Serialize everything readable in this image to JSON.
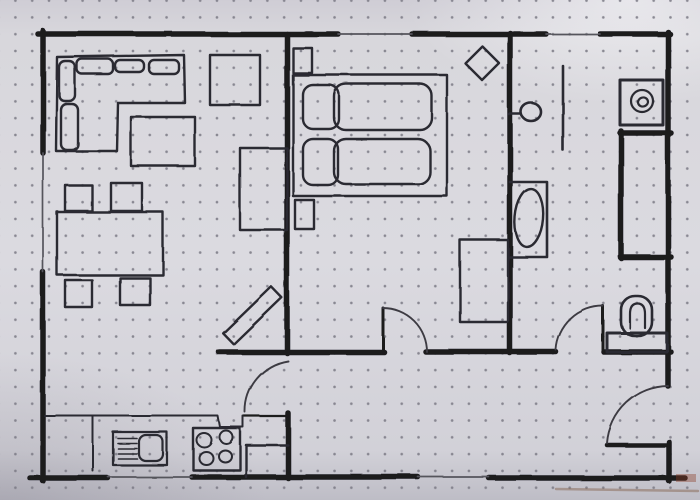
{
  "meta": {
    "description": "hand-drawn apartment floor plan sketched in black marker on dot-grid paper",
    "visible_text": "none"
  },
  "style": {
    "paper_color": "#d8d7dc",
    "dot_color": "#7a7984",
    "wall_ink": "#1b1a1f",
    "furniture_ink": "#2a2930",
    "thin_ink": "#3c3b43",
    "window_ink": "#55545c",
    "wall_stroke": 5.5,
    "furniture_stroke": 2.4,
    "arc_stroke": 1.9,
    "window_stroke": 1.7
  },
  "plan": {
    "walls": [
      {
        "name": "wall-top-living",
        "x1": 38,
        "y1": 34,
        "x2": 338,
        "y2": 34
      },
      {
        "name": "wall-top-bedroom-right",
        "x1": 412,
        "y1": 34,
        "x2": 546,
        "y2": 34
      },
      {
        "name": "wall-top-bathroom",
        "x1": 600,
        "y1": 34,
        "x2": 670,
        "y2": 34
      },
      {
        "name": "wall-left-upper",
        "x1": 43,
        "y1": 31,
        "x2": 43,
        "y2": 153
      },
      {
        "name": "wall-left-lower",
        "x1": 43,
        "y1": 272,
        "x2": 43,
        "y2": 481
      },
      {
        "name": "wall-bottom-left",
        "x1": 30,
        "y1": 478,
        "x2": 108,
        "y2": 478
      },
      {
        "name": "wall-bottom-middle",
        "x1": 192,
        "y1": 477,
        "x2": 418,
        "y2": 477
      },
      {
        "name": "wall-bottom-right",
        "x1": 489,
        "y1": 478,
        "x2": 685,
        "y2": 478
      },
      {
        "name": "wall-right-upper",
        "x1": 668,
        "y1": 32,
        "x2": 668,
        "y2": 386
      },
      {
        "name": "wall-right-lower",
        "x1": 669,
        "y1": 442,
        "x2": 669,
        "y2": 481
      },
      {
        "name": "wall-living-bedroom",
        "x1": 287,
        "y1": 34,
        "x2": 287,
        "y2": 353
      },
      {
        "name": "wall-hall-top-left",
        "x1": 219,
        "y1": 352,
        "x2": 384,
        "y2": 352
      },
      {
        "name": "wall-hall-top-middle",
        "x1": 426,
        "y1": 352,
        "x2": 556,
        "y2": 352
      },
      {
        "name": "wall-wc-bottom",
        "x1": 604,
        "y1": 352,
        "x2": 671,
        "y2": 352
      },
      {
        "name": "wall-bedroom-bathroom",
        "x1": 510,
        "y1": 33,
        "x2": 510,
        "y2": 353
      },
      {
        "name": "wall-kitchen-door-jamb",
        "x1": 288,
        "y1": 413,
        "x2": 288,
        "y2": 478
      },
      {
        "name": "wall-closet-top",
        "x1": 620,
        "y1": 133,
        "x2": 671,
        "y2": 133
      },
      {
        "name": "wall-closet-left",
        "x1": 621,
        "y1": 131,
        "x2": 621,
        "y2": 258
      },
      {
        "name": "wall-closet-bottom",
        "x1": 620,
        "y1": 257,
        "x2": 671,
        "y2": 257
      }
    ],
    "windows": [
      {
        "name": "window-top-bedroom",
        "x1": 338,
        "y1": 34,
        "x2": 412,
        "y2": 34
      },
      {
        "name": "window-top-bathroom",
        "x1": 546,
        "y1": 34,
        "x2": 600,
        "y2": 34
      },
      {
        "name": "window-left-living",
        "x1": 43,
        "y1": 153,
        "x2": 43,
        "y2": 272
      },
      {
        "name": "window-bottom-kitchen",
        "x1": 108,
        "y1": 477,
        "x2": 192,
        "y2": 477
      },
      {
        "name": "window-bottom-hall",
        "x1": 418,
        "y1": 477,
        "x2": 489,
        "y2": 477
      }
    ],
    "doors": [
      {
        "name": "door-bedroom",
        "leaf": [
          383,
          352,
          383,
          308
        ],
        "leaf_w": 3,
        "arc": "M383,308 A44,44 0 0 1 427,352"
      },
      {
        "name": "door-kitchen",
        "leaf": [
          288,
          416,
          244,
          416
        ],
        "leaf_w": 2.2,
        "arc": "M288,361 A51,51 0 0 0 245,412"
      },
      {
        "name": "door-bathroom",
        "leaf": [
          603,
          352,
          603,
          306
        ],
        "leaf_w": 3,
        "arc": "M603,306 A47,47 0 0 0 556,350"
      },
      {
        "name": "door-entrance",
        "leaf": [
          607,
          445,
          669,
          445
        ],
        "leaf_w": 4.5,
        "arc": "M607,443 A62,62 0 0 1 668,386"
      }
    ],
    "furniture": [
      {
        "name": "corner-sofa-outline",
        "room": "living-room",
        "shape": "polygon",
        "points": "57,57 184,55 185,103 118,103 117,151 56,151"
      },
      {
        "name": "sofa-cushion",
        "room": "living-room",
        "shape": "rect",
        "x": 77,
        "y": 59,
        "w": 36,
        "h": 15,
        "rx": 5
      },
      {
        "name": "sofa-cushion",
        "room": "living-room",
        "shape": "rect",
        "x": 115,
        "y": 60,
        "w": 29,
        "h": 12,
        "rx": 5
      },
      {
        "name": "sofa-cushion",
        "room": "living-room",
        "shape": "rect",
        "x": 149,
        "y": 60,
        "w": 30,
        "h": 14,
        "rx": 5
      },
      {
        "name": "sofa-cushion",
        "room": "living-room",
        "shape": "rect",
        "x": 59,
        "y": 61,
        "w": 16,
        "h": 40,
        "rx": 6
      },
      {
        "name": "sofa-cushion",
        "room": "living-room",
        "shape": "rect",
        "x": 61,
        "y": 104,
        "w": 17,
        "h": 46,
        "rx": 6
      },
      {
        "name": "side-table",
        "room": "living-room",
        "shape": "rect",
        "x": 210,
        "y": 55,
        "w": 50,
        "h": 50
      },
      {
        "name": "coffee-table",
        "room": "living-room",
        "shape": "rect",
        "x": 131,
        "y": 117,
        "w": 64,
        "h": 49
      },
      {
        "name": "desk",
        "room": "living-room",
        "shape": "rect",
        "x": 240,
        "y": 148,
        "w": 47,
        "h": 82
      },
      {
        "name": "dining-table",
        "room": "living-room",
        "shape": "rect",
        "x": 57,
        "y": 212,
        "w": 106,
        "h": 63
      },
      {
        "name": "dining-chair",
        "room": "living-room",
        "shape": "rect",
        "x": 65,
        "y": 185,
        "w": 27,
        "h": 26
      },
      {
        "name": "dining-chair",
        "room": "living-room",
        "shape": "rect",
        "x": 111,
        "y": 183,
        "w": 31,
        "h": 28
      },
      {
        "name": "dining-chair",
        "room": "living-room",
        "shape": "rect",
        "x": 65,
        "y": 280,
        "w": 27,
        "h": 27
      },
      {
        "name": "dining-chair",
        "room": "living-room",
        "shape": "rect",
        "x": 120,
        "y": 278,
        "w": 30,
        "h": 27
      },
      {
        "name": "sideboard-diagonal",
        "room": "living-room",
        "shape": "rect",
        "x": 219,
        "y": 308,
        "w": 67,
        "h": 15,
        "rot": -44
      },
      {
        "name": "nightstand",
        "room": "bedroom",
        "shape": "rect",
        "x": 293,
        "y": 48,
        "w": 19,
        "h": 25
      },
      {
        "name": "nightstand",
        "room": "bedroom",
        "shape": "rect",
        "x": 295,
        "y": 200,
        "w": 19,
        "h": 29
      },
      {
        "name": "double-bed-frame",
        "room": "bedroom",
        "shape": "rect",
        "x": 293,
        "y": 75,
        "w": 154,
        "h": 121
      },
      {
        "name": "pillow",
        "room": "bedroom",
        "shape": "rect",
        "x": 303,
        "y": 85,
        "w": 36,
        "h": 44,
        "rx": 10
      },
      {
        "name": "pillow",
        "room": "bedroom",
        "shape": "rect",
        "x": 303,
        "y": 139,
        "w": 35,
        "h": 46,
        "rx": 10
      },
      {
        "name": "duvet",
        "room": "bedroom",
        "shape": "rect",
        "x": 334,
        "y": 84,
        "w": 98,
        "h": 46,
        "rx": 12
      },
      {
        "name": "duvet",
        "room": "bedroom",
        "shape": "rect",
        "x": 334,
        "y": 139,
        "w": 96,
        "h": 45,
        "rx": 12
      },
      {
        "name": "plant-diamond",
        "room": "bedroom",
        "shape": "polygon",
        "points": "482,46 499,63 482,80 465,63"
      },
      {
        "name": "wardrobe",
        "room": "bedroom",
        "shape": "rect",
        "x": 460,
        "y": 240,
        "w": 48,
        "h": 82
      },
      {
        "name": "wall-hook-stem",
        "room": "bathroom",
        "shape": "line",
        "x1": 509,
        "y1": 114,
        "x2": 521,
        "y2": 114,
        "sw": 2.6
      },
      {
        "name": "wall-hook-ring",
        "room": "bathroom",
        "shape": "ellipse",
        "cx": 531,
        "cy": 112,
        "rx": 10,
        "ry": 9,
        "sw": 2.6
      },
      {
        "name": "radiator-line",
        "room": "bathroom",
        "shape": "line",
        "x1": 563,
        "y1": 66,
        "x2": 563,
        "y2": 150,
        "sw": 2.6
      },
      {
        "name": "washing-machine",
        "room": "bathroom",
        "shape": "rect",
        "x": 620,
        "y": 80,
        "w": 43,
        "h": 45,
        "sw": 3
      },
      {
        "name": "washing-machine-drum",
        "room": "bathroom",
        "shape": "circle",
        "cx": 642,
        "cy": 101,
        "r": 11,
        "sw": 2.2
      },
      {
        "name": "washing-machine-door",
        "room": "bathroom",
        "shape": "ellipse",
        "cx": 643,
        "cy": 102,
        "rx": 5,
        "ry": 4.5,
        "rot": -15,
        "sw": 2.2
      },
      {
        "name": "washbasin-unit",
        "room": "bathroom",
        "shape": "path",
        "d": "M510,182 L547,182 L547,257 L510,257",
        "sw": 2.6
      },
      {
        "name": "washbasin-bowl",
        "room": "bathroom",
        "shape": "ellipse",
        "cx": 529,
        "cy": 218,
        "rx": 14,
        "ry": 29,
        "rot": 5,
        "sw": 2.4
      },
      {
        "name": "toilet-tank",
        "room": "wc",
        "shape": "rect",
        "x": 607,
        "y": 333,
        "w": 60,
        "h": 19,
        "sw": 3
      },
      {
        "name": "toilet-bowl",
        "room": "wc",
        "shape": "rect",
        "x": 621,
        "y": 296,
        "w": 31,
        "h": 40,
        "rx": 14,
        "sw": 2.6
      },
      {
        "name": "toilet-seat",
        "room": "wc",
        "shape": "path",
        "d": "M630,328 L630,314 Q630,303.5 637.5,303.5 Q645,303.5 645,314 L645,328",
        "sw": 2.2
      },
      {
        "name": "counter-edge",
        "room": "kitchen",
        "shape": "polyline",
        "points": "45,416 218,416 220,427 243,427 243,416",
        "sw": 2
      },
      {
        "name": "counter-divider",
        "room": "kitchen",
        "shape": "line",
        "x1": 93,
        "y1": 417,
        "x2": 93,
        "y2": 471,
        "sw": 2
      },
      {
        "name": "corner-cabinet",
        "room": "kitchen",
        "shape": "polyline",
        "points": "288,445 246,445 246,477",
        "sw": 2.4
      },
      {
        "name": "sink-unit",
        "room": "kitchen",
        "shape": "rect",
        "x": 113,
        "y": 432,
        "w": 54,
        "h": 33,
        "sw": 2.2
      },
      {
        "name": "sink-drainer-line",
        "room": "kitchen",
        "shape": "line",
        "x1": 118,
        "y1": 438.5,
        "x2": 137,
        "y2": 438.5,
        "sw": 1.6
      },
      {
        "name": "sink-drainer-line",
        "room": "kitchen",
        "shape": "line",
        "x1": 118,
        "y1": 443.5,
        "x2": 137,
        "y2": 443.5,
        "sw": 1.6
      },
      {
        "name": "sink-drainer-line",
        "room": "kitchen",
        "shape": "line",
        "x1": 118,
        "y1": 448.5,
        "x2": 137,
        "y2": 448.5,
        "sw": 1.6
      },
      {
        "name": "sink-drainer-line",
        "room": "kitchen",
        "shape": "line",
        "x1": 118,
        "y1": 453.5,
        "x2": 137,
        "y2": 453.5,
        "sw": 1.6
      },
      {
        "name": "sink-drainer-line",
        "room": "kitchen",
        "shape": "line",
        "x1": 118,
        "y1": 458.5,
        "x2": 137,
        "y2": 458.5,
        "sw": 1.6
      },
      {
        "name": "sink-basin",
        "room": "kitchen",
        "shape": "rect",
        "x": 139,
        "y": 435,
        "w": 24,
        "h": 26,
        "rx": 7,
        "sw": 2.2
      },
      {
        "name": "stove",
        "room": "kitchen",
        "shape": "rect",
        "x": 193,
        "y": 428,
        "w": 47,
        "h": 42,
        "sw": 2.4
      },
      {
        "name": "stove-burner",
        "room": "kitchen",
        "shape": "ellipse",
        "cx": 204,
        "cy": 440,
        "rx": 7.5,
        "ry": 7,
        "sw": 2
      },
      {
        "name": "stove-burner",
        "room": "kitchen",
        "shape": "ellipse",
        "cx": 226,
        "cy": 437,
        "rx": 6.5,
        "ry": 6.5,
        "sw": 2
      },
      {
        "name": "stove-burner",
        "room": "kitchen",
        "shape": "ellipse",
        "cx": 206,
        "cy": 458,
        "rx": 7,
        "ry": 6.5,
        "sw": 2
      },
      {
        "name": "stove-burner",
        "room": "kitchen",
        "shape": "ellipse",
        "cx": 225,
        "cy": 456,
        "rx": 6.5,
        "ry": 6,
        "sw": 2
      }
    ],
    "artifacts": [
      {
        "name": "marker-smudge",
        "shape": "line",
        "x1": 556,
        "y1": 489,
        "x2": 698,
        "y2": 491,
        "stroke": "#856552",
        "sw": 2.5,
        "opacity": 0.5
      },
      {
        "name": "ink-blot-corner",
        "shape": "rect",
        "x": 676,
        "y": 474,
        "w": 20,
        "h": 8,
        "fill": "rgba(140,62,40,0.4)",
        "sw": 0
      }
    ]
  }
}
